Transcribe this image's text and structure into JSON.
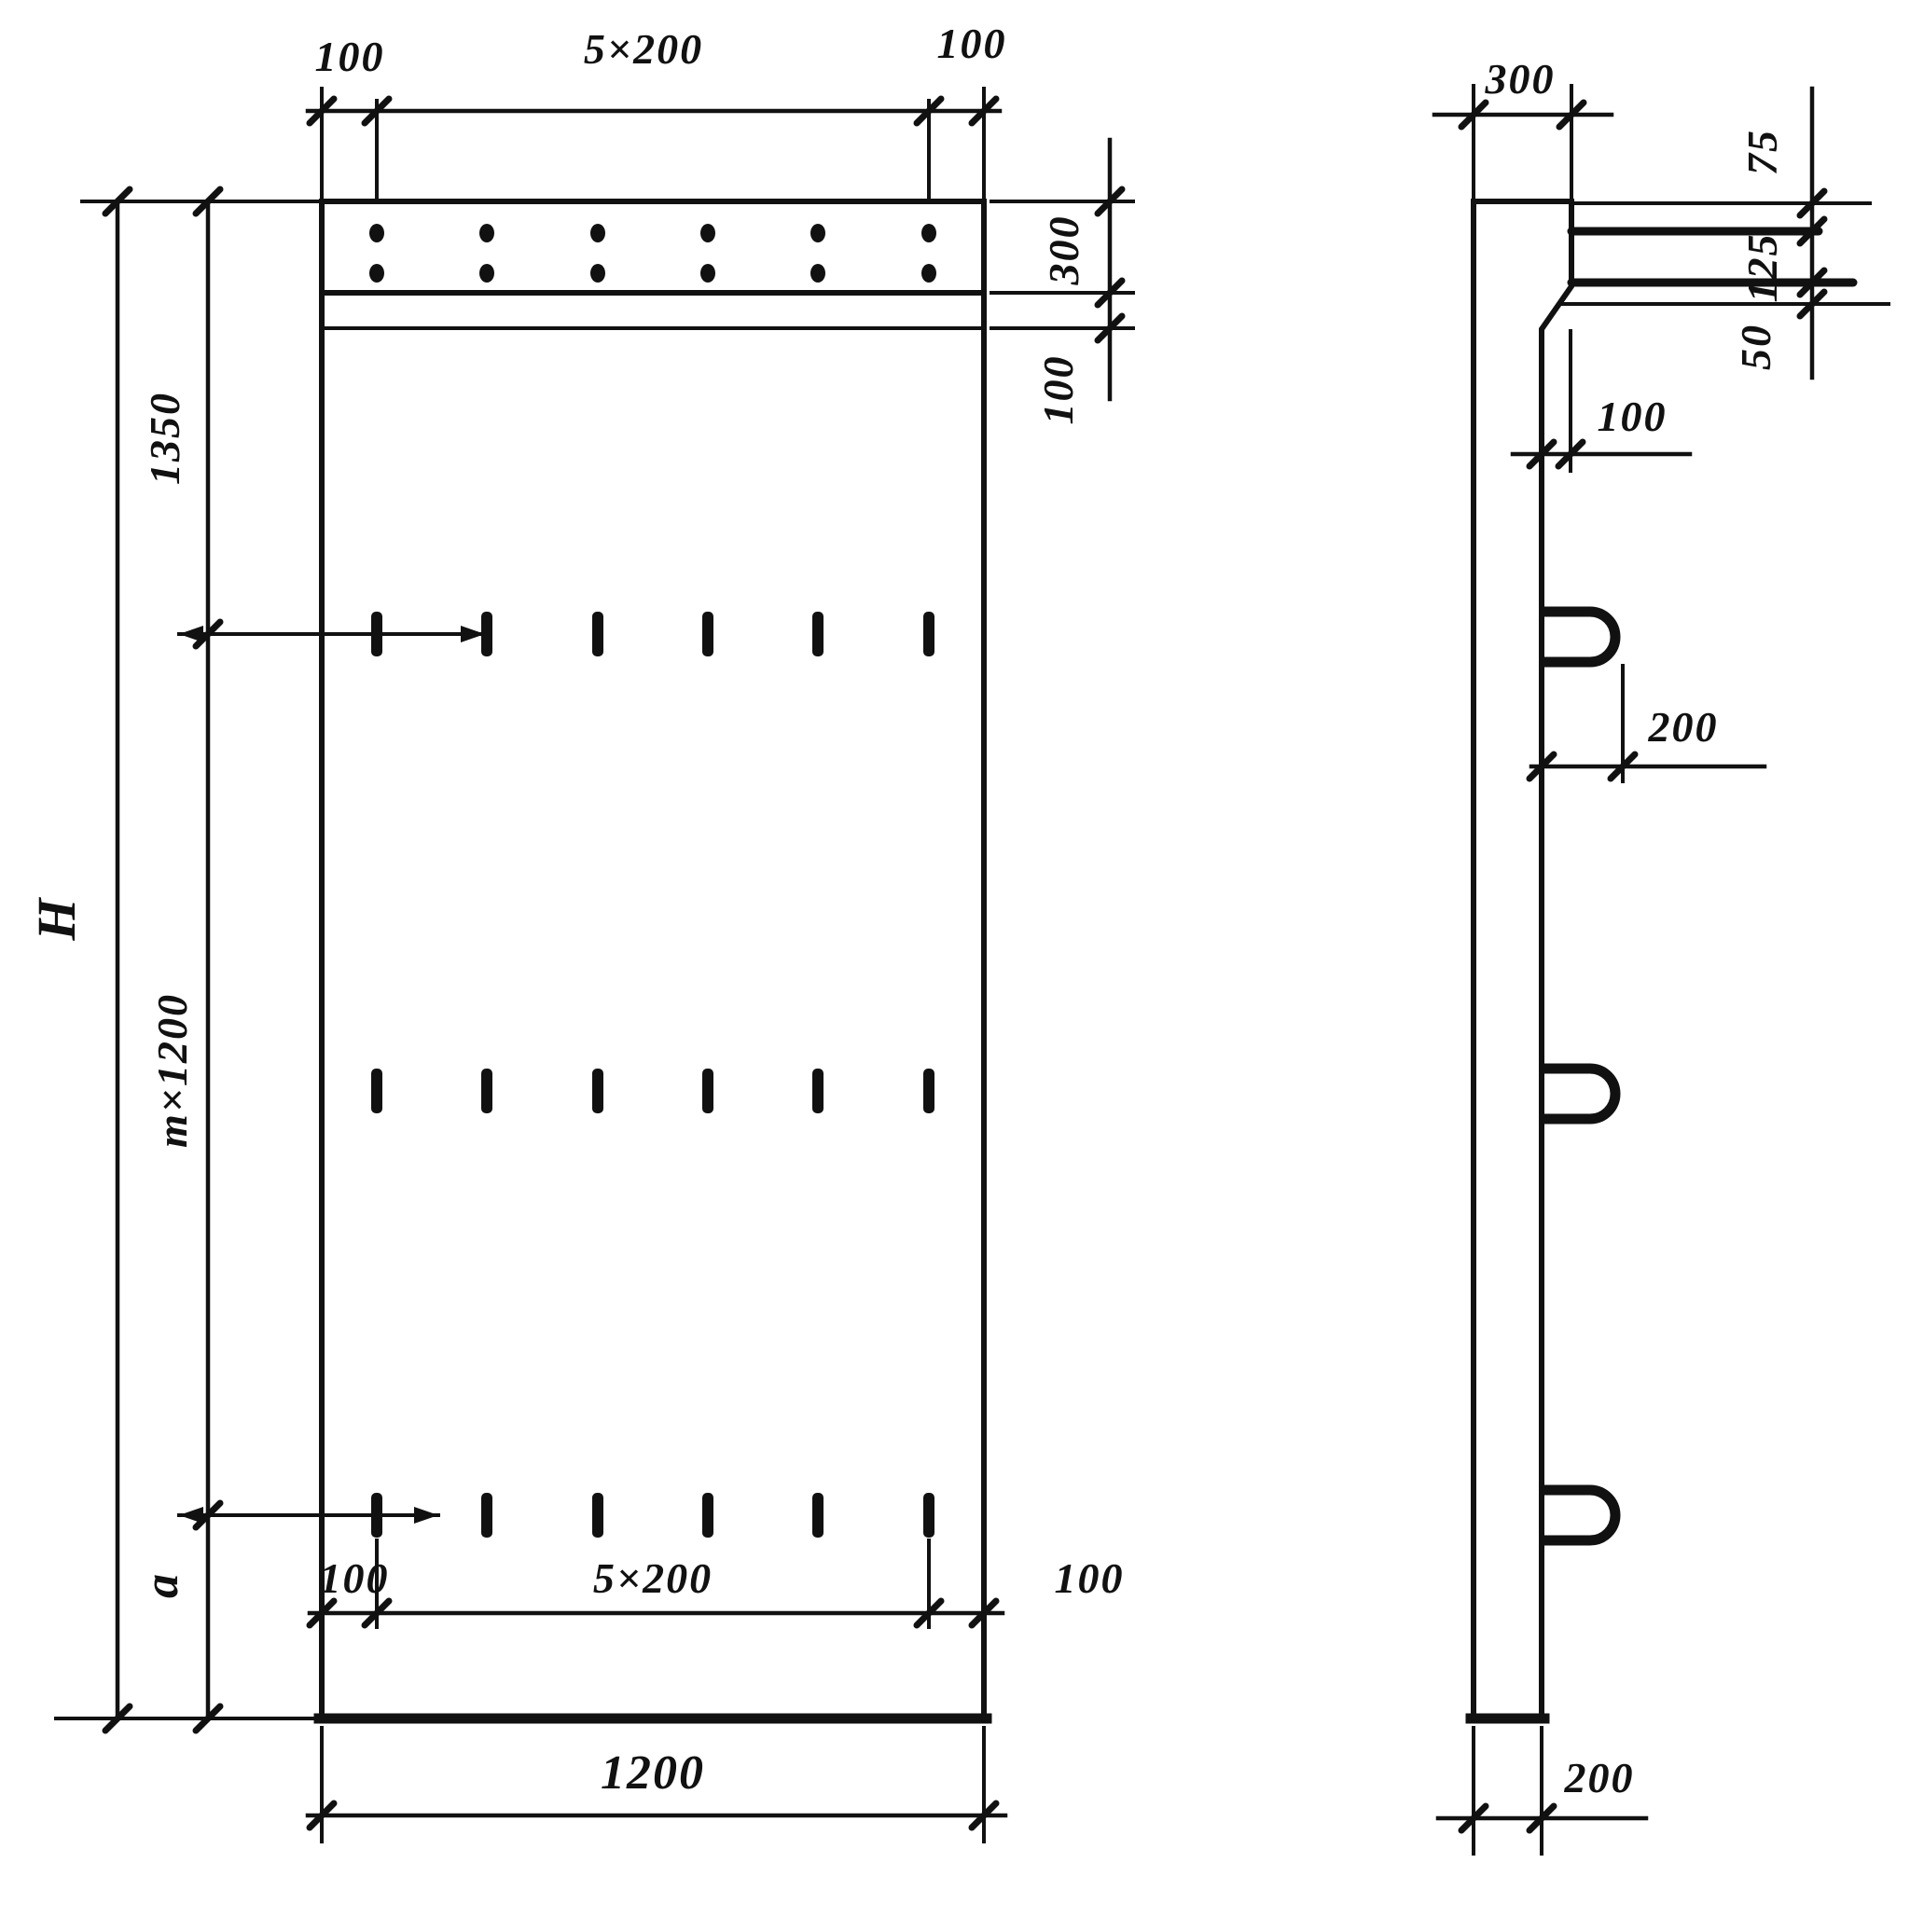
{
  "drawing": {
    "kind": "panel-technical-drawing",
    "labels": {
      "front": {
        "top_margin_left": "100",
        "top_pitch": "5×200",
        "top_margin_right": "100",
        "band_height": "300",
        "band_strip": "100",
        "segment_top": "1350",
        "segment_middle": "m×1200",
        "segment_bottom": "a",
        "height_total": "H",
        "bottom_margin_left": "100",
        "bottom_pitch": "5×200",
        "bottom_margin_right": "100",
        "width_total": "1200"
      },
      "side": {
        "top_width": "300",
        "plate_top_offset": "75",
        "plate_gap": "125",
        "plate_bottom_offset": "50",
        "chamfer_depth": "100",
        "loop_protrusion": "200",
        "bottom_width": "200"
      }
    }
  }
}
